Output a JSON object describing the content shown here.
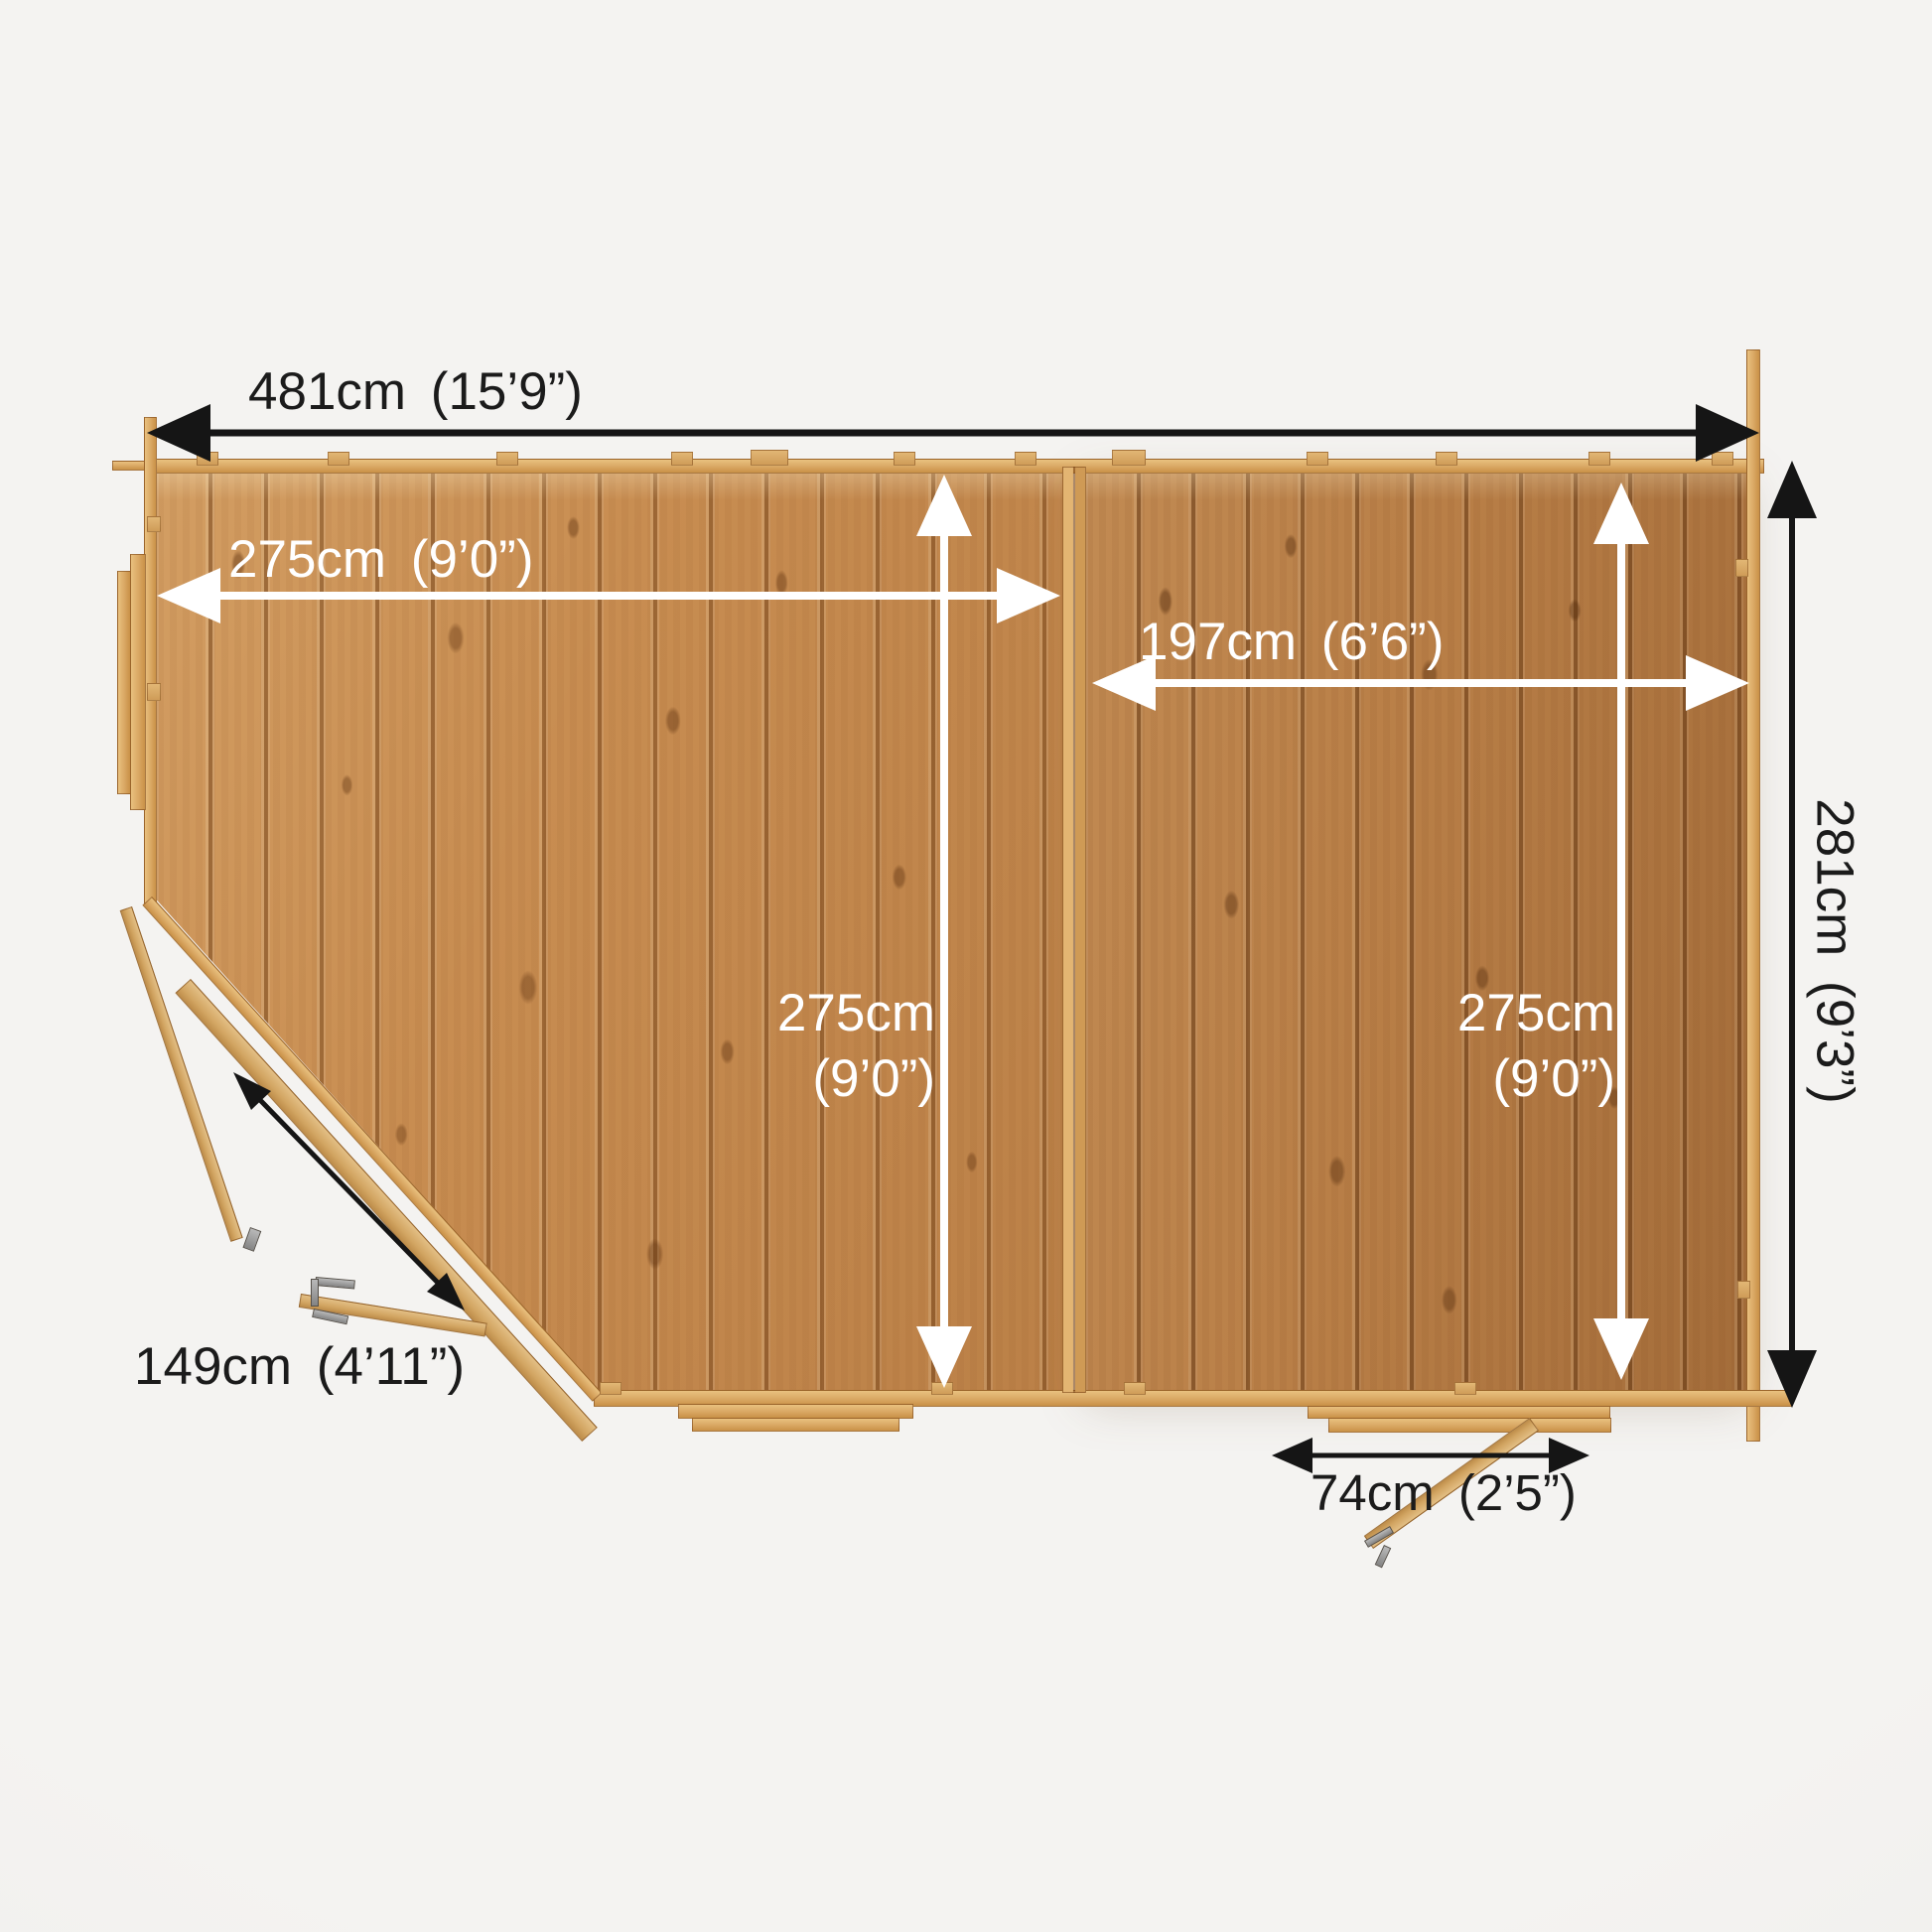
{
  "title": "Corner summerhouse floor plan - top view with dimensions",
  "colors": {
    "background": "#f2f1ee",
    "floor_left_room": "#c88d51",
    "floor_right_room": "#b97f47",
    "wall_wood": "#d9a763",
    "dimension_text_black": "#1b1b1b",
    "dimension_text_white": "#ffffff"
  },
  "dimensions": {
    "overall_width": {
      "label": "481cm (15’9”)"
    },
    "left_room_width": {
      "label": "275cm (9’0”)"
    },
    "right_room_width": {
      "label": "197cm (6’6”)"
    },
    "left_room_depth": {
      "line1": "275cm",
      "line2": "(9’0”)"
    },
    "right_room_depth": {
      "line1": "275cm",
      "line2": "(9’0”)"
    },
    "overall_depth": {
      "label": "281cm (9’3”)"
    },
    "corner_door_width": {
      "label": "149cm (4’11”)"
    },
    "side_door_width": {
      "label": "74cm (2’5”)"
    }
  }
}
